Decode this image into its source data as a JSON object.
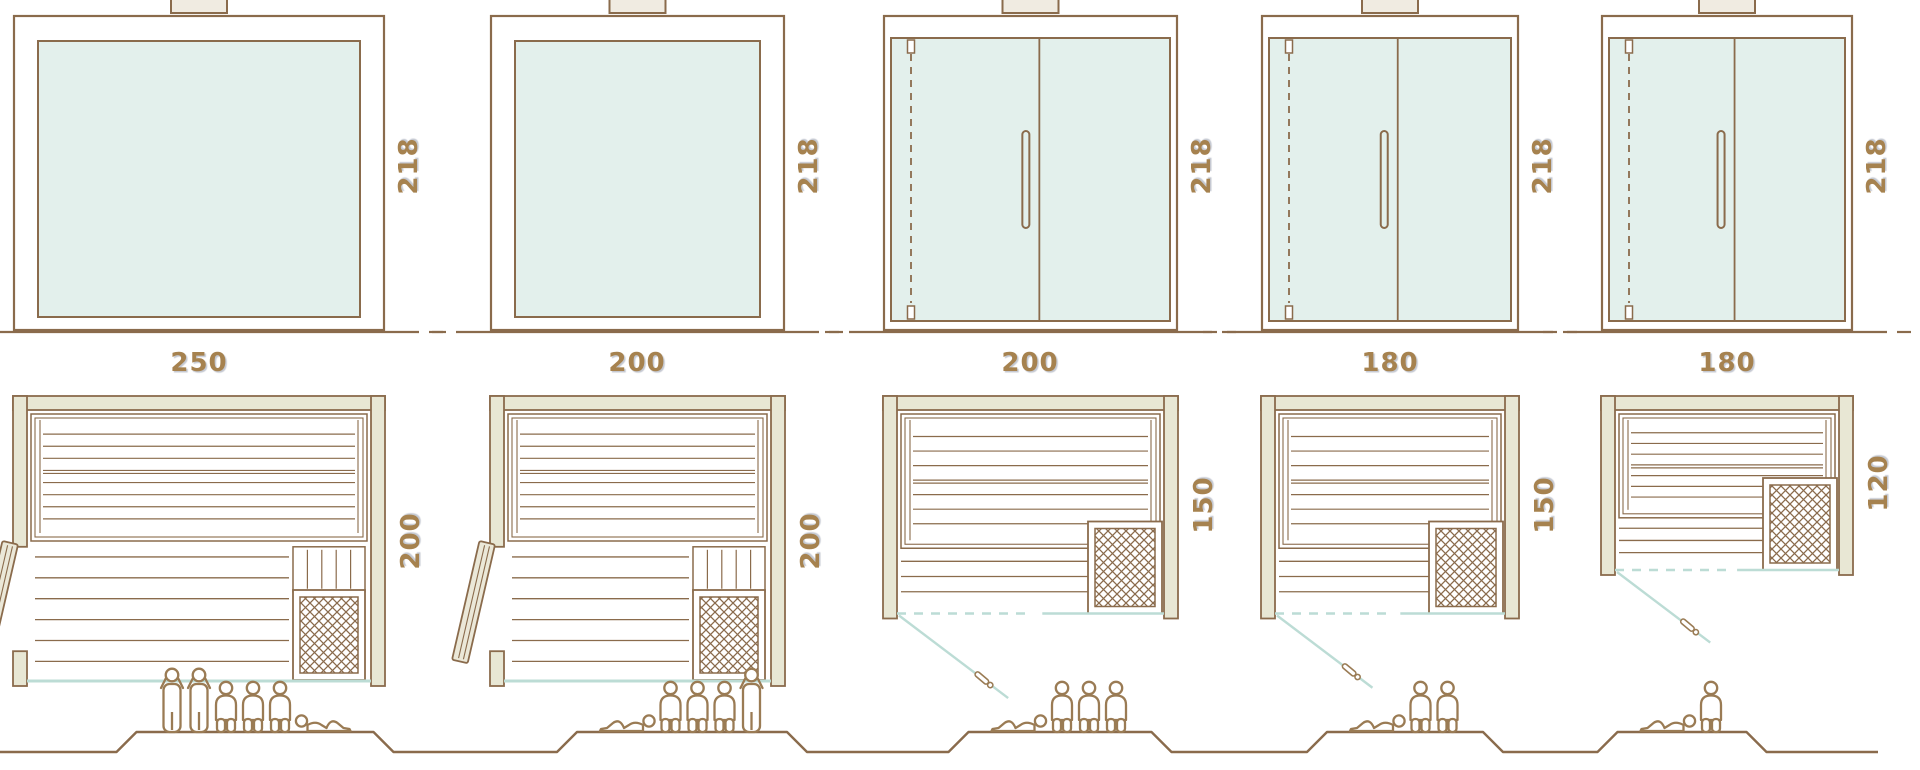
{
  "diagram": {
    "type": "sauna-size-comparison",
    "rows": [
      "front-elevation",
      "width-label",
      "floor-plan",
      "capacity-figures"
    ],
    "saunas": [
      {
        "name": "sauna-250x200",
        "width_label": "250",
        "height_label": "218",
        "depth_label": "200",
        "width_cm": 250,
        "depth_cm": 200,
        "height_cm": 218,
        "door": "wood-side-door",
        "heater": "bottom-right",
        "capacity": 6,
        "people": [
          "standing",
          "standing",
          "sitting",
          "sitting",
          "sitting",
          "lying"
        ]
      },
      {
        "name": "sauna-200x200",
        "width_label": "200",
        "height_label": "218",
        "depth_label": "200",
        "width_cm": 200,
        "depth_cm": 200,
        "height_cm": 218,
        "door": "wood-side-door",
        "heater": "bottom-right",
        "capacity": 5,
        "people": [
          "lying",
          "sitting",
          "sitting",
          "sitting",
          "standing"
        ]
      },
      {
        "name": "sauna-200x150",
        "width_label": "200",
        "height_label": "218",
        "depth_label": "150",
        "width_cm": 200,
        "depth_cm": 150,
        "height_cm": 218,
        "door": "front-glass-door",
        "heater": "bottom-right",
        "capacity": 4,
        "people": [
          "lying",
          "sitting",
          "sitting",
          "sitting"
        ]
      },
      {
        "name": "sauna-180x150",
        "width_label": "180",
        "height_label": "218",
        "depth_label": "150",
        "width_cm": 180,
        "depth_cm": 150,
        "height_cm": 218,
        "door": "front-glass-door",
        "heater": "bottom-right",
        "capacity": 3,
        "people": [
          "lying",
          "sitting",
          "sitting"
        ]
      },
      {
        "name": "sauna-180x120",
        "width_label": "180",
        "height_label": "218",
        "depth_label": "120",
        "width_cm": 180,
        "depth_cm": 120,
        "height_cm": 218,
        "door": "front-glass-door",
        "heater": "bottom-right",
        "capacity": 2,
        "people": [
          "lying",
          "sitting"
        ]
      }
    ],
    "colors": {
      "outline": "#8a6b4c",
      "label_text": "#a6824f",
      "wall_fill": "#e8e7d4",
      "glass_fill": "#e3f0ec",
      "glass_line": "#bcdcd5",
      "door_fill": "#ebe8d8",
      "figure": "#9a7b54",
      "chimney_fill": "#f0ebe1",
      "background": "#ffffff"
    }
  }
}
